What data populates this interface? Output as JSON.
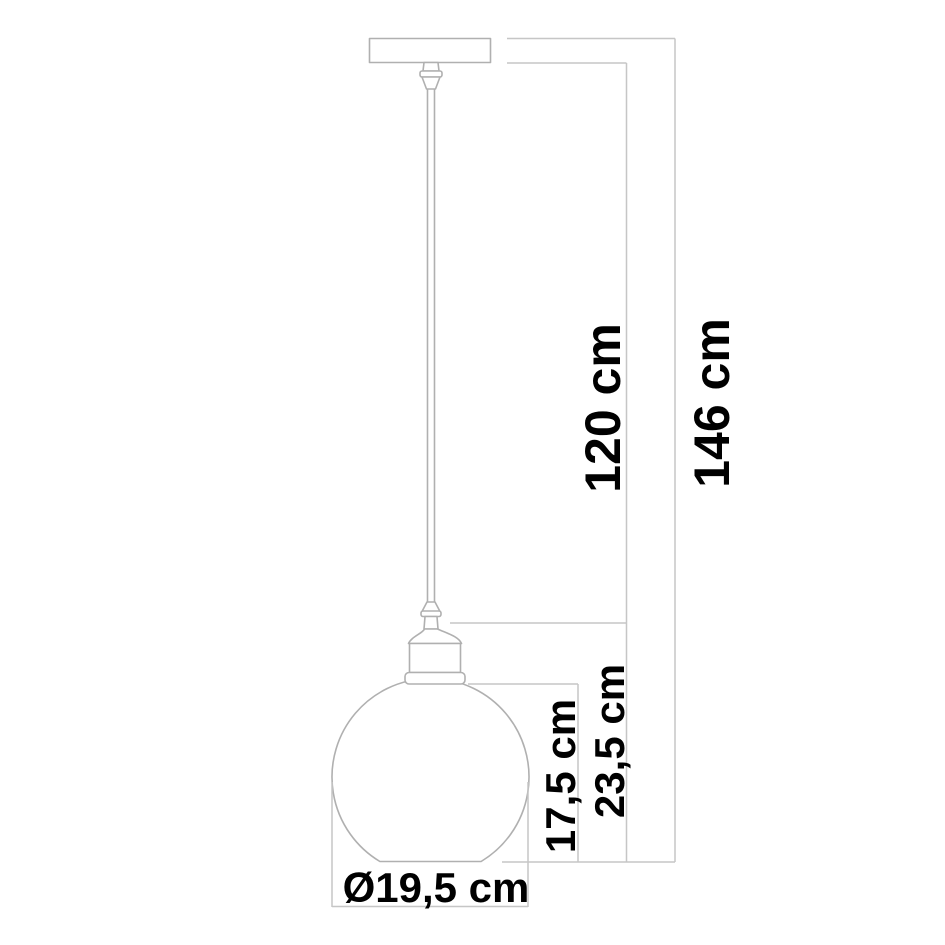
{
  "title": "Pendant lamp dimension drawing",
  "labels": {
    "cord_drop": "120 cm",
    "total_height": "146 cm",
    "glass_height": "17,5 cm",
    "shade_with_socket_height": "23,5 cm",
    "shade_diameter": "Ø19,5 cm"
  },
  "colors": {
    "background": "#ffffff",
    "drawing_line": "#b0b0b0",
    "dimension_line": "#c6c6c6",
    "text": "#000000"
  }
}
